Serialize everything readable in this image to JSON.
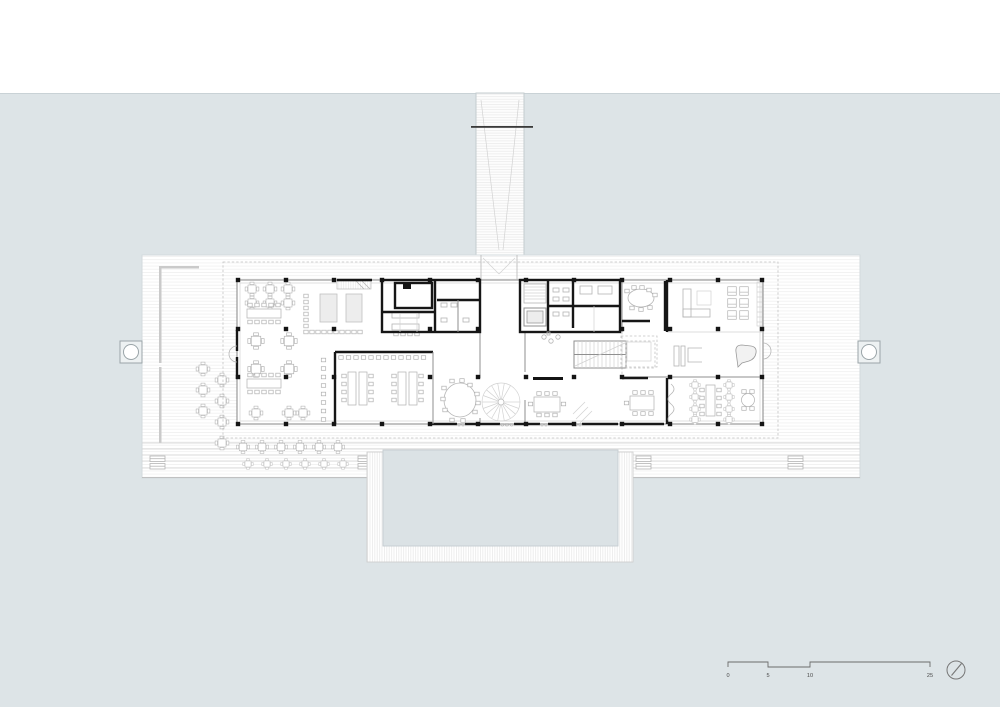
{
  "page": {
    "background_color": "#dde4e7",
    "paper_color": "#ffffff",
    "pool_color": "#dbe2e5",
    "wall_color": "#161616",
    "line_color": "#8f8f8f"
  },
  "scale_bar": {
    "labels": [
      "0",
      "5",
      "10",
      "25"
    ]
  },
  "north_arrow": {
    "icon": "compass-needle-icon"
  }
}
